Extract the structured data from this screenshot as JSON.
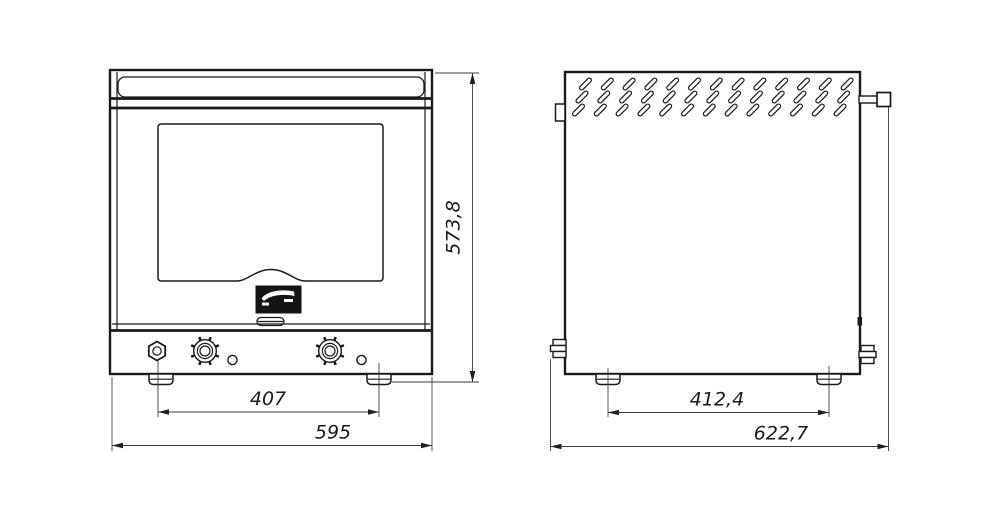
{
  "front_view": {
    "dim_feet_spacing": "407",
    "dim_overall_width": "595",
    "dim_overall_height": "573,8",
    "logo_icon": "brand-logo"
  },
  "side_view": {
    "dim_feet_spacing": "412,4",
    "dim_overall_depth": "622,7"
  },
  "colors": {
    "line": "#1a1a1a",
    "background": "#ffffff"
  }
}
